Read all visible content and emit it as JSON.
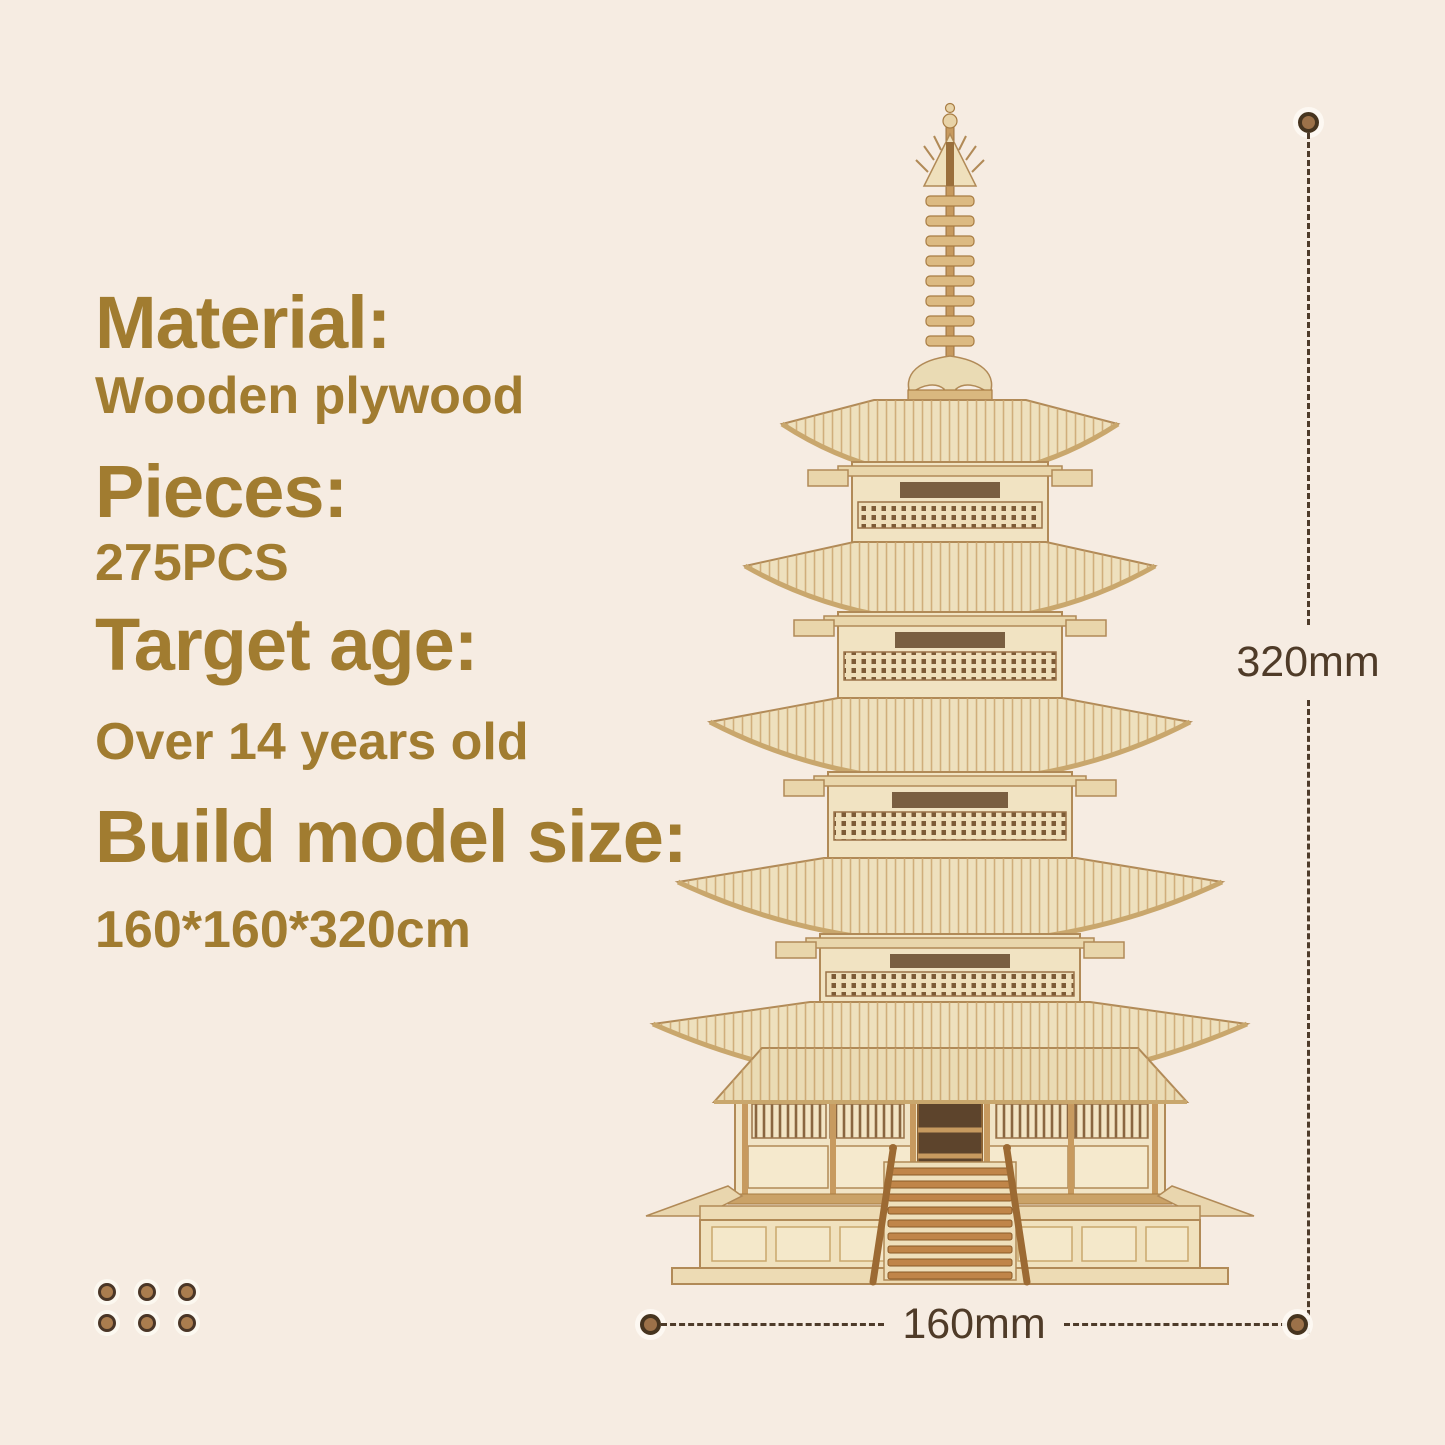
{
  "specs": {
    "sections": [
      {
        "heading": "Material:",
        "value": "Wooden plywood"
      },
      {
        "heading": "Pieces:",
        "value": "275PCS"
      },
      {
        "heading": "Target age:",
        "value": "Over 14 years old"
      },
      {
        "heading": "Build model size:",
        "value": "160*160*320cm"
      }
    ]
  },
  "dimensions": {
    "height_label": "320mm",
    "width_label": "160mm"
  },
  "image": {
    "subject": "Five-storied pagoda 3D wooden puzzle model"
  },
  "decoration": {
    "dot_rows": 2,
    "dot_columns": 3
  },
  "colors": {
    "background": "#f6ece2",
    "text_gold": "#a17c30",
    "dimension_line": "#4e3b2a",
    "dimension_dot": "#9c7149",
    "wood_light": "#eee0bd",
    "wood_outline": "#b18a57"
  }
}
